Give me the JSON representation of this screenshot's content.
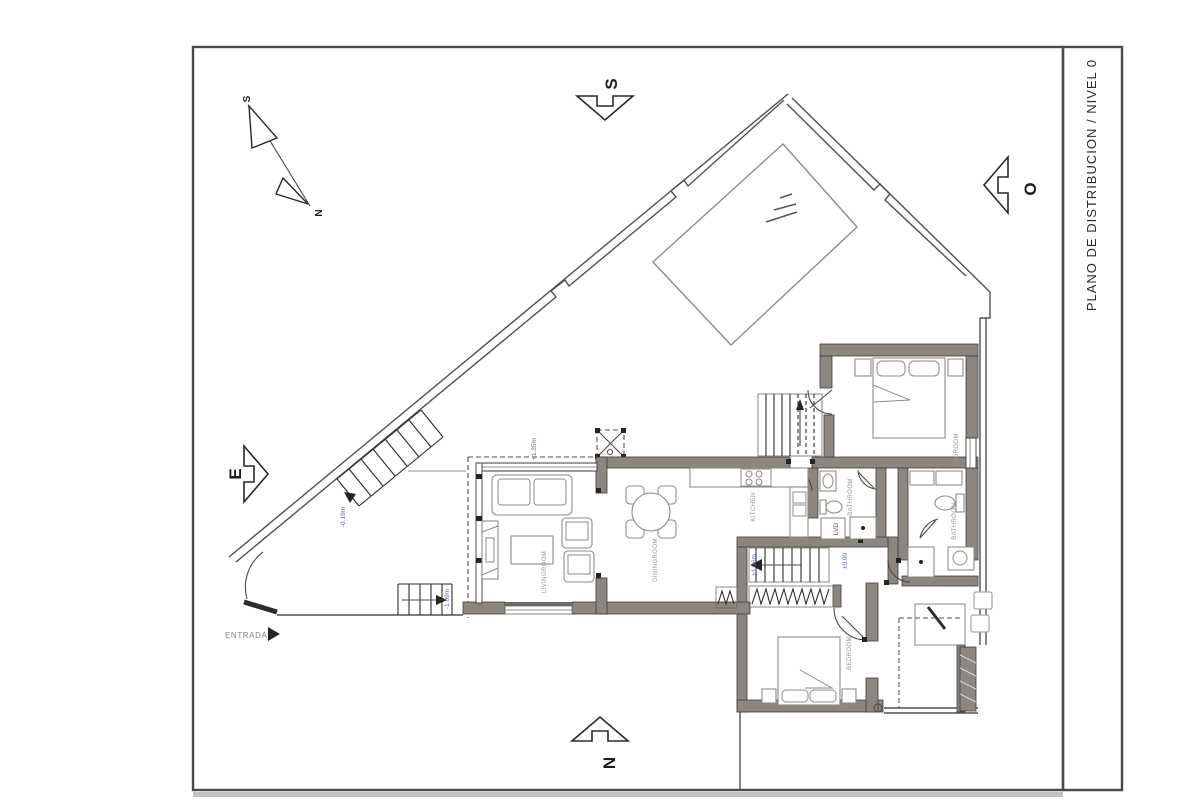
{
  "title_block": {
    "title": "PLANO DE DISTRIBUCION / NIVEL 0"
  },
  "compass": {
    "north_rose": {
      "top": "S",
      "bottom": "N"
    },
    "orientation_arrows": {
      "top": "S",
      "left": "E",
      "right": "O",
      "bottom": "N"
    }
  },
  "entrance": {
    "label": "ENTRADA"
  },
  "rooms": {
    "livingroom": {
      "label": "LIVINGROOM"
    },
    "diningroom": {
      "label": "DININGROOM"
    },
    "kitchen": {
      "label": "KITCHEN"
    },
    "bathroom_1": {
      "label": "BATHROOM"
    },
    "bathroom_2": {
      "label": "BATHROOM"
    },
    "bedroom_1": {
      "label": "BEDROOM"
    },
    "bedroom_2": {
      "label": "BEDROOM"
    },
    "laundry": {
      "label": "LVD"
    }
  },
  "levels": {
    "terrace": "+1.35m",
    "stair_up": "+1.36m",
    "ground": "±0.00",
    "ramp": "-0.19m",
    "entry_steps": "-1.09m"
  },
  "colors": {
    "wall": "#8b8680",
    "line": "#4b4845",
    "level_text": "#5c6f9e",
    "room_text": "#9b9189",
    "paper": "#ffffff"
  }
}
